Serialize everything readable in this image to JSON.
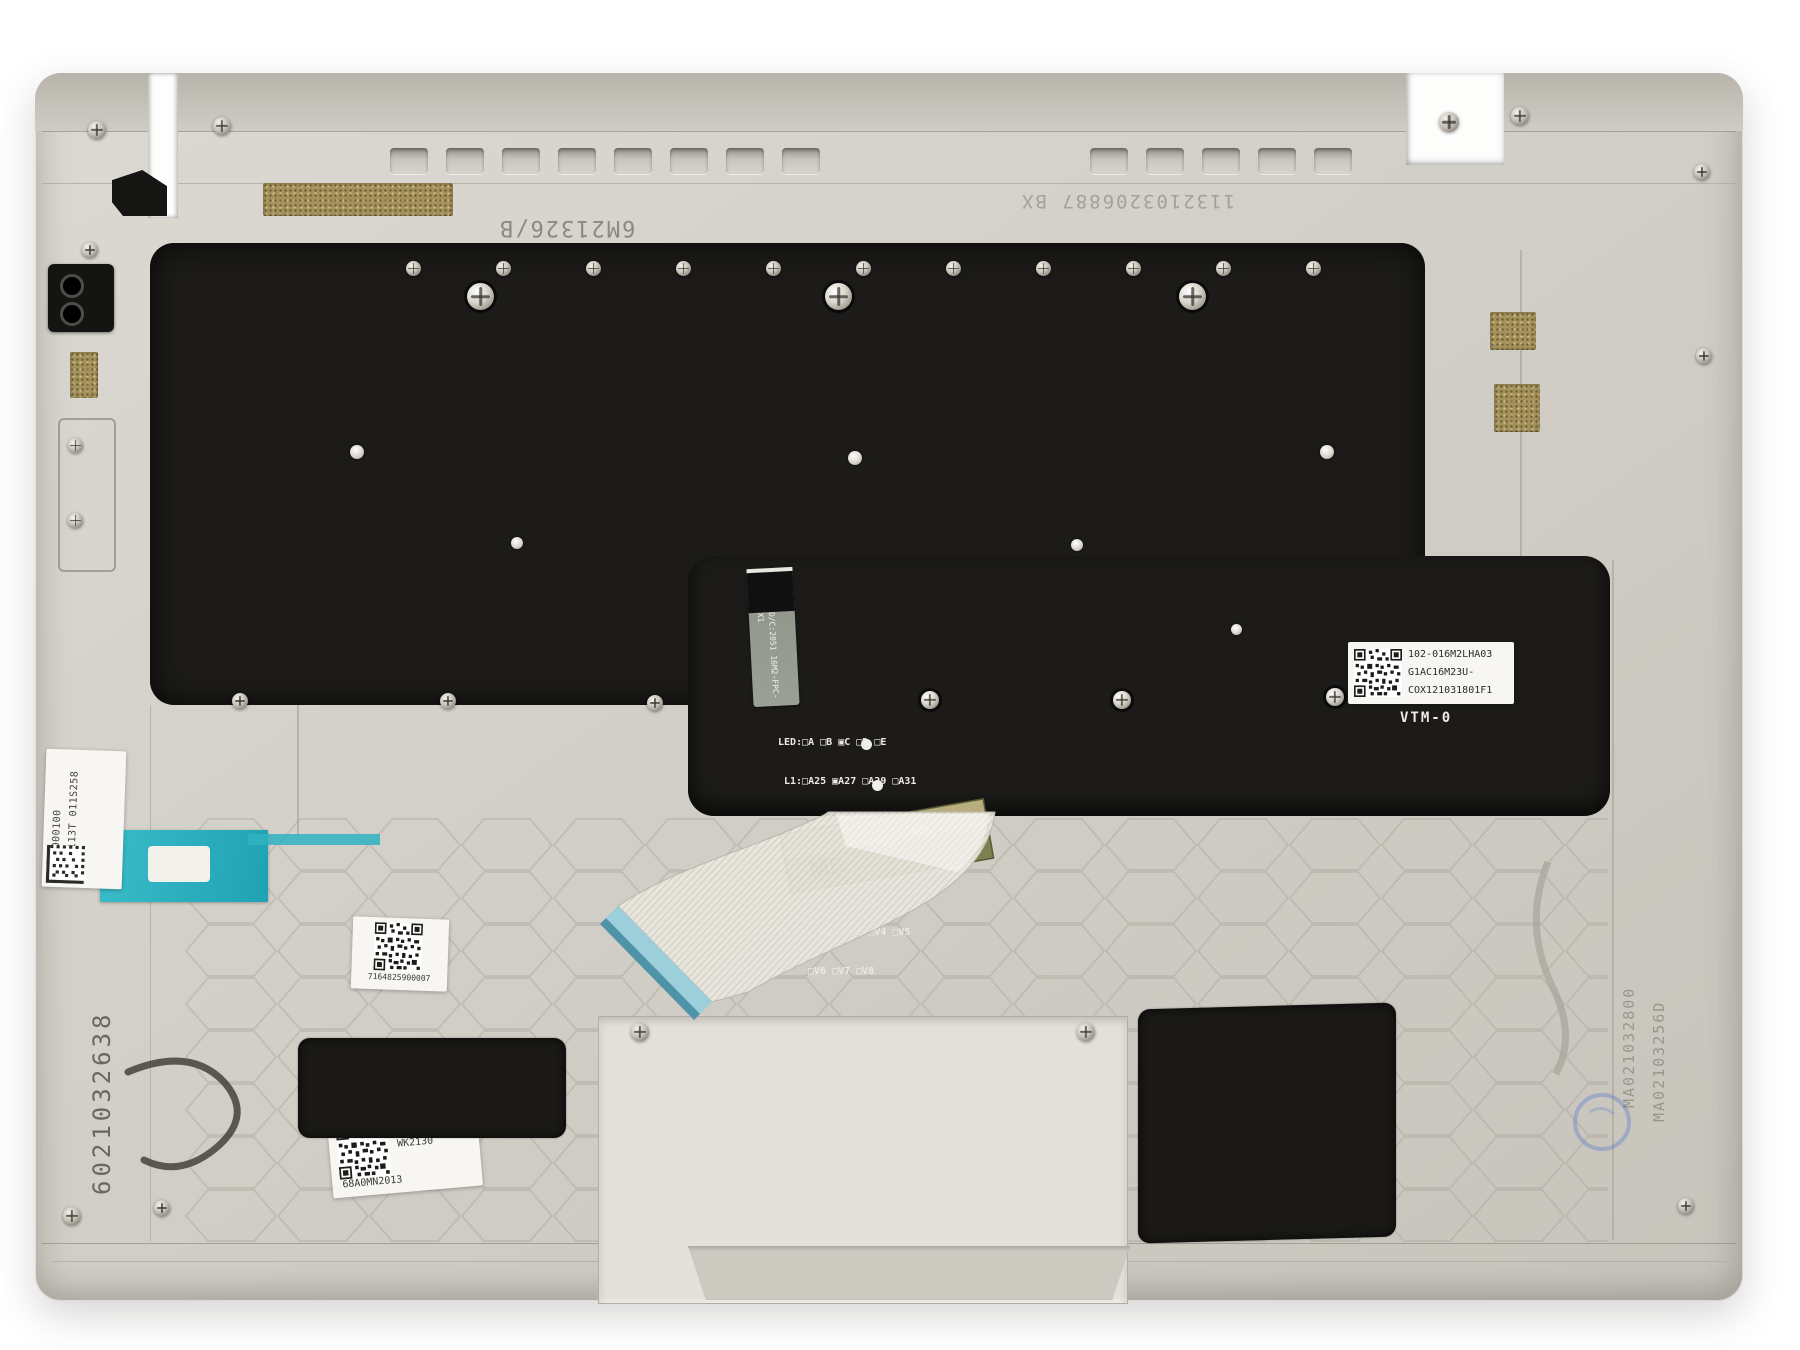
{
  "meta": {
    "title": "Laptop palmrest top-cover inner side with backlit keyboard plate"
  },
  "stamps": {
    "top_left": "6M21326/B",
    "top_right": "1132103206887 BX",
    "left_vertical": "6021032638",
    "right_vertical_a": "MA021032800",
    "right_vertical_b": "MA02103256D"
  },
  "plate": {
    "config_lines": [
      "LED:□A □B ▣C □D □E",
      "L1:□A25 ▣A27 □A29 □A31",
      "COLOR:□bk2 □bj2 ▣g62",
      "□o52 □o51",
      "VF:□V1 ▣V2 □V3 □V4 □V5",
      "□V6 □V7 □V8"
    ],
    "model_code": "VTM-0",
    "barcode_label": {
      "line1": "102-016M2LHA03",
      "line2": "G1AC16M23U-",
      "line3": "COX121031801F1"
    },
    "fpc_line1": "D/C:2051",
    "fpc_line2": "16M2-FPC-X1"
  },
  "labels": {
    "side": {
      "line1": "AM36W000100",
      "line2": "MGD10113T",
      "line3": "011S258"
    },
    "qr_mid": {
      "code": "7164825900007"
    },
    "qr_bottom": {
      "line1": "WK2130",
      "line2": "68A0MN2013"
    }
  },
  "tape": {
    "brand": "3M",
    "series": "VHB"
  },
  "colors": {
    "body_silver": "#d1cec7",
    "plate_black": "#1c1b19",
    "teal_sticker": "#35b9c9",
    "tape_olive": "#7d8150",
    "tape_tan": "#b7ad7e",
    "gold_mesh": "#a5915a",
    "ribbon_tip_blue": "#9ccfdc",
    "stamp_ink": "#5f5b4e",
    "blue_stamp": "#5073c8"
  }
}
